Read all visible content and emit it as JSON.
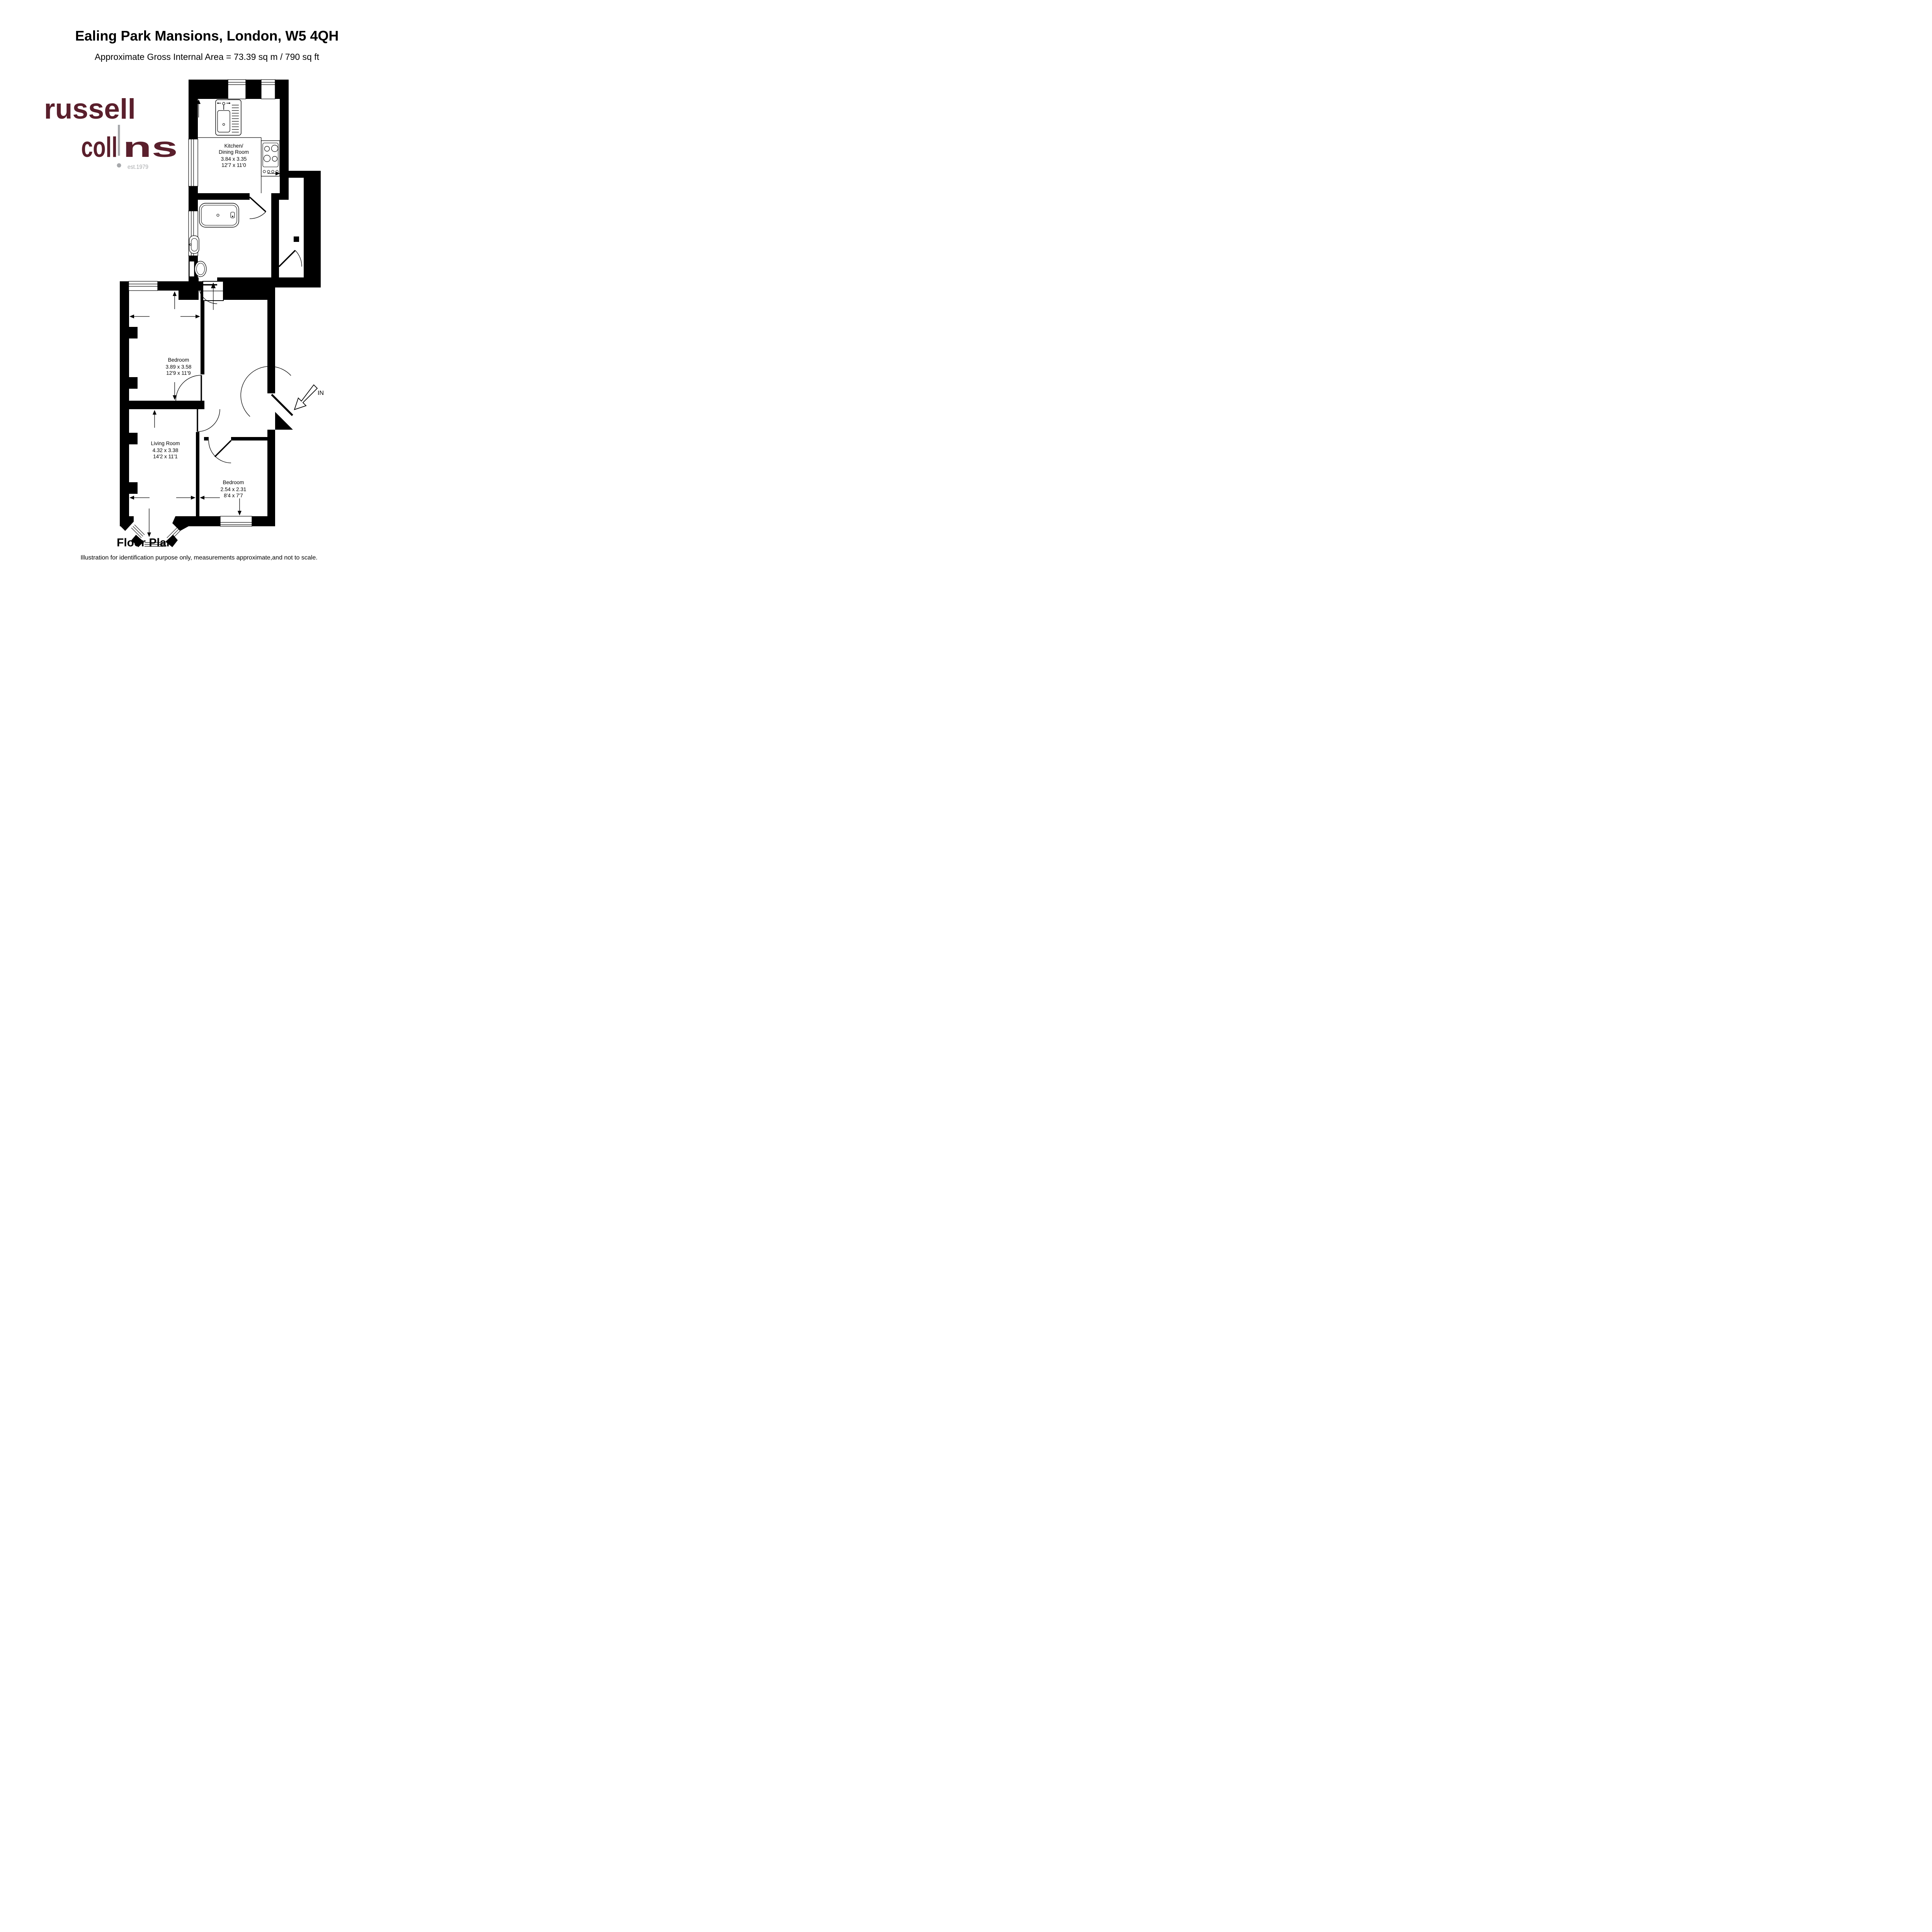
{
  "header": {
    "title": "Ealing Park Mansions, London, W5 4QH",
    "subtitle": "Approximate Gross Internal Area = 73.39 sq m / 790 sq ft"
  },
  "logo": {
    "line1": "russell",
    "line2_pre": "coll",
    "line2_post": "ns",
    "est": "est.1979",
    "brand_color": "#5a1f2c",
    "gray_color": "#a7a9ac"
  },
  "plan": {
    "entrance_label": "IN",
    "rooms": {
      "kitchen": {
        "line1": "Kitchen/",
        "line2": "Dining Room",
        "metric": "3.84 x 3.35",
        "imperial": "12'7 x 11'0"
      },
      "bedroom1": {
        "name": "Bedroom",
        "metric": "3.89 x 3.58",
        "imperial": "12'9 x 11'9"
      },
      "living": {
        "name": "Living Room",
        "metric": "4.32 x 3.38",
        "imperial": "14'2 x 11'1"
      },
      "bedroom2": {
        "name": "Bedroom",
        "metric": "2.54 x 2.31",
        "imperial": "8'4 x 7'7"
      }
    }
  },
  "footer": {
    "heading": "Floor Plan",
    "disclaimer": "Illustration for identification purpose only, measurements approximate,and not to scale."
  }
}
